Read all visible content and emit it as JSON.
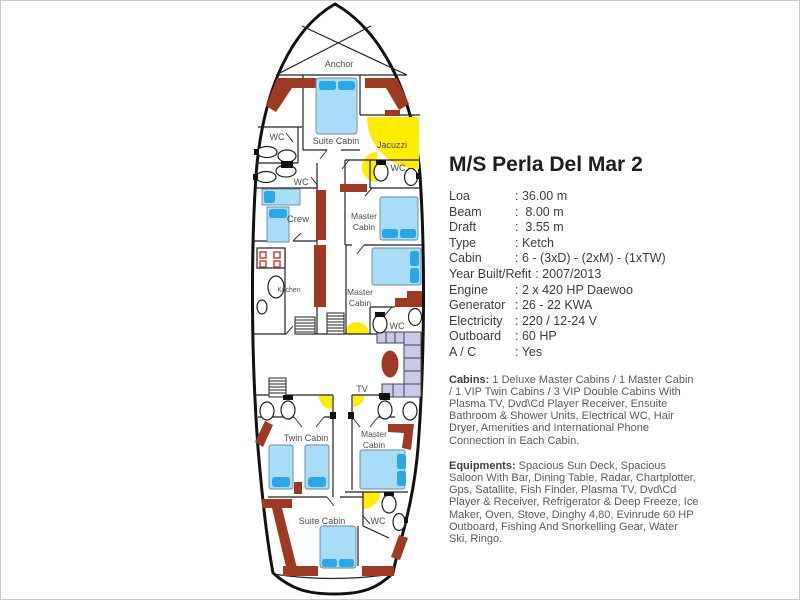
{
  "title": "M/S Perla Del Mar 2",
  "specs": [
    {
      "label": "Loa",
      "value": ": 36.00 m"
    },
    {
      "label": "Beam",
      "value": ":  8.00 m"
    },
    {
      "label": "Draft",
      "value": ":  3.55 m"
    },
    {
      "label": "Type",
      "value": ": Ketch"
    },
    {
      "label": "Cabin",
      "value": ": 6 - (3xD) - (2xM) - (1xTW)"
    },
    {
      "label": "Year Built/Refit",
      "value": ": 2007/2013"
    },
    {
      "label": "Engine",
      "value": ": 2 x 420 HP Daewoo"
    },
    {
      "label": "Generator",
      "value": ": 26 - 22 KWA"
    },
    {
      "label": "Electricity",
      "value": ": 220 / 12-24 V"
    },
    {
      "label": "Outboard",
      "value": ": 60 HP"
    },
    {
      "label": "A / C",
      "value": ": Yes"
    }
  ],
  "cabins": {
    "heading": "Cabins:",
    "text": " 1 Deluxe Master Cabins / 1 Master Cabin /  1 VIP Twin Cabins / 3 VIP Double Cabins With Plasma TV, Dvd\\Cd Player Receiver, Ensuite Bathroom & Shower Units, Electrical WC, Hair Dryer, Amenities and International Phone Connection in Each Cabin."
  },
  "equipments": {
    "heading": "Equipments:",
    "text": " Spacious Sun Deck, Spacious Saloon With Bar, Dining Table, Radar, Chartplotter, Gps, Satallite, Fish Finder, Plasma TV, Dvd\\Cd Player & Receiver, Refrigerator & Deep Freeze, Ice Maker, Oven, Stove, Dinghy 4,80, Evinrude 60 HP Outboard, Fishing And Snorkelling Gear, Water Ski, Ringo."
  },
  "plan": {
    "labels": {
      "anchor": "Anchor",
      "suite_cabin": "Suite Cabin",
      "wc": "WC",
      "jacuzzi": "Jacuzzi",
      "crew": "Crew",
      "kitchen": "Kitchen",
      "master": "Master",
      "cabin": "Cabin",
      "twin_cabin": "Twin Cabin",
      "tv": "TV"
    },
    "colors": {
      "bulkhead_red": "#9e3a22",
      "bed_blue": "#a9dcf6",
      "pillow_blue": "#2ba7e8",
      "light_yellow": "#ffec00",
      "sofa_lavender": "#c9c9e9",
      "hull_black": "#111111"
    }
  }
}
